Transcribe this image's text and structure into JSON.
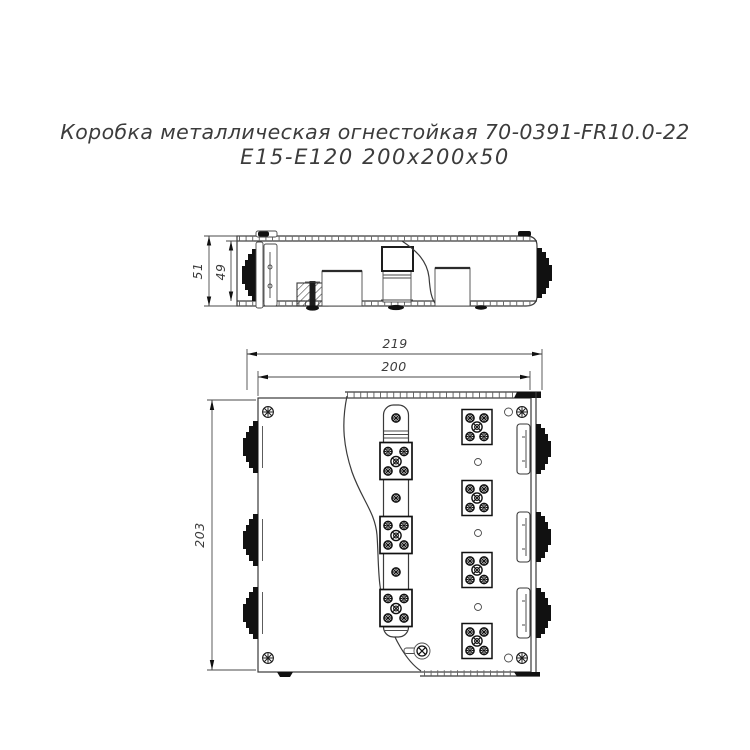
{
  "title": {
    "line1": "Коробка металлическая огнестойкая 70-0391-FR10.0-22",
    "line2": "Е15-Е120 200х200х50"
  },
  "dimensions": {
    "side_height_outer": "51",
    "side_height_inner": "49",
    "top_width_outer": "219",
    "top_width_inner": "200",
    "top_height": "203"
  },
  "colors": {
    "line": "#3a3a3a",
    "text": "#3c3c3c",
    "dark_fill": "#111111",
    "background": "#ffffff"
  }
}
